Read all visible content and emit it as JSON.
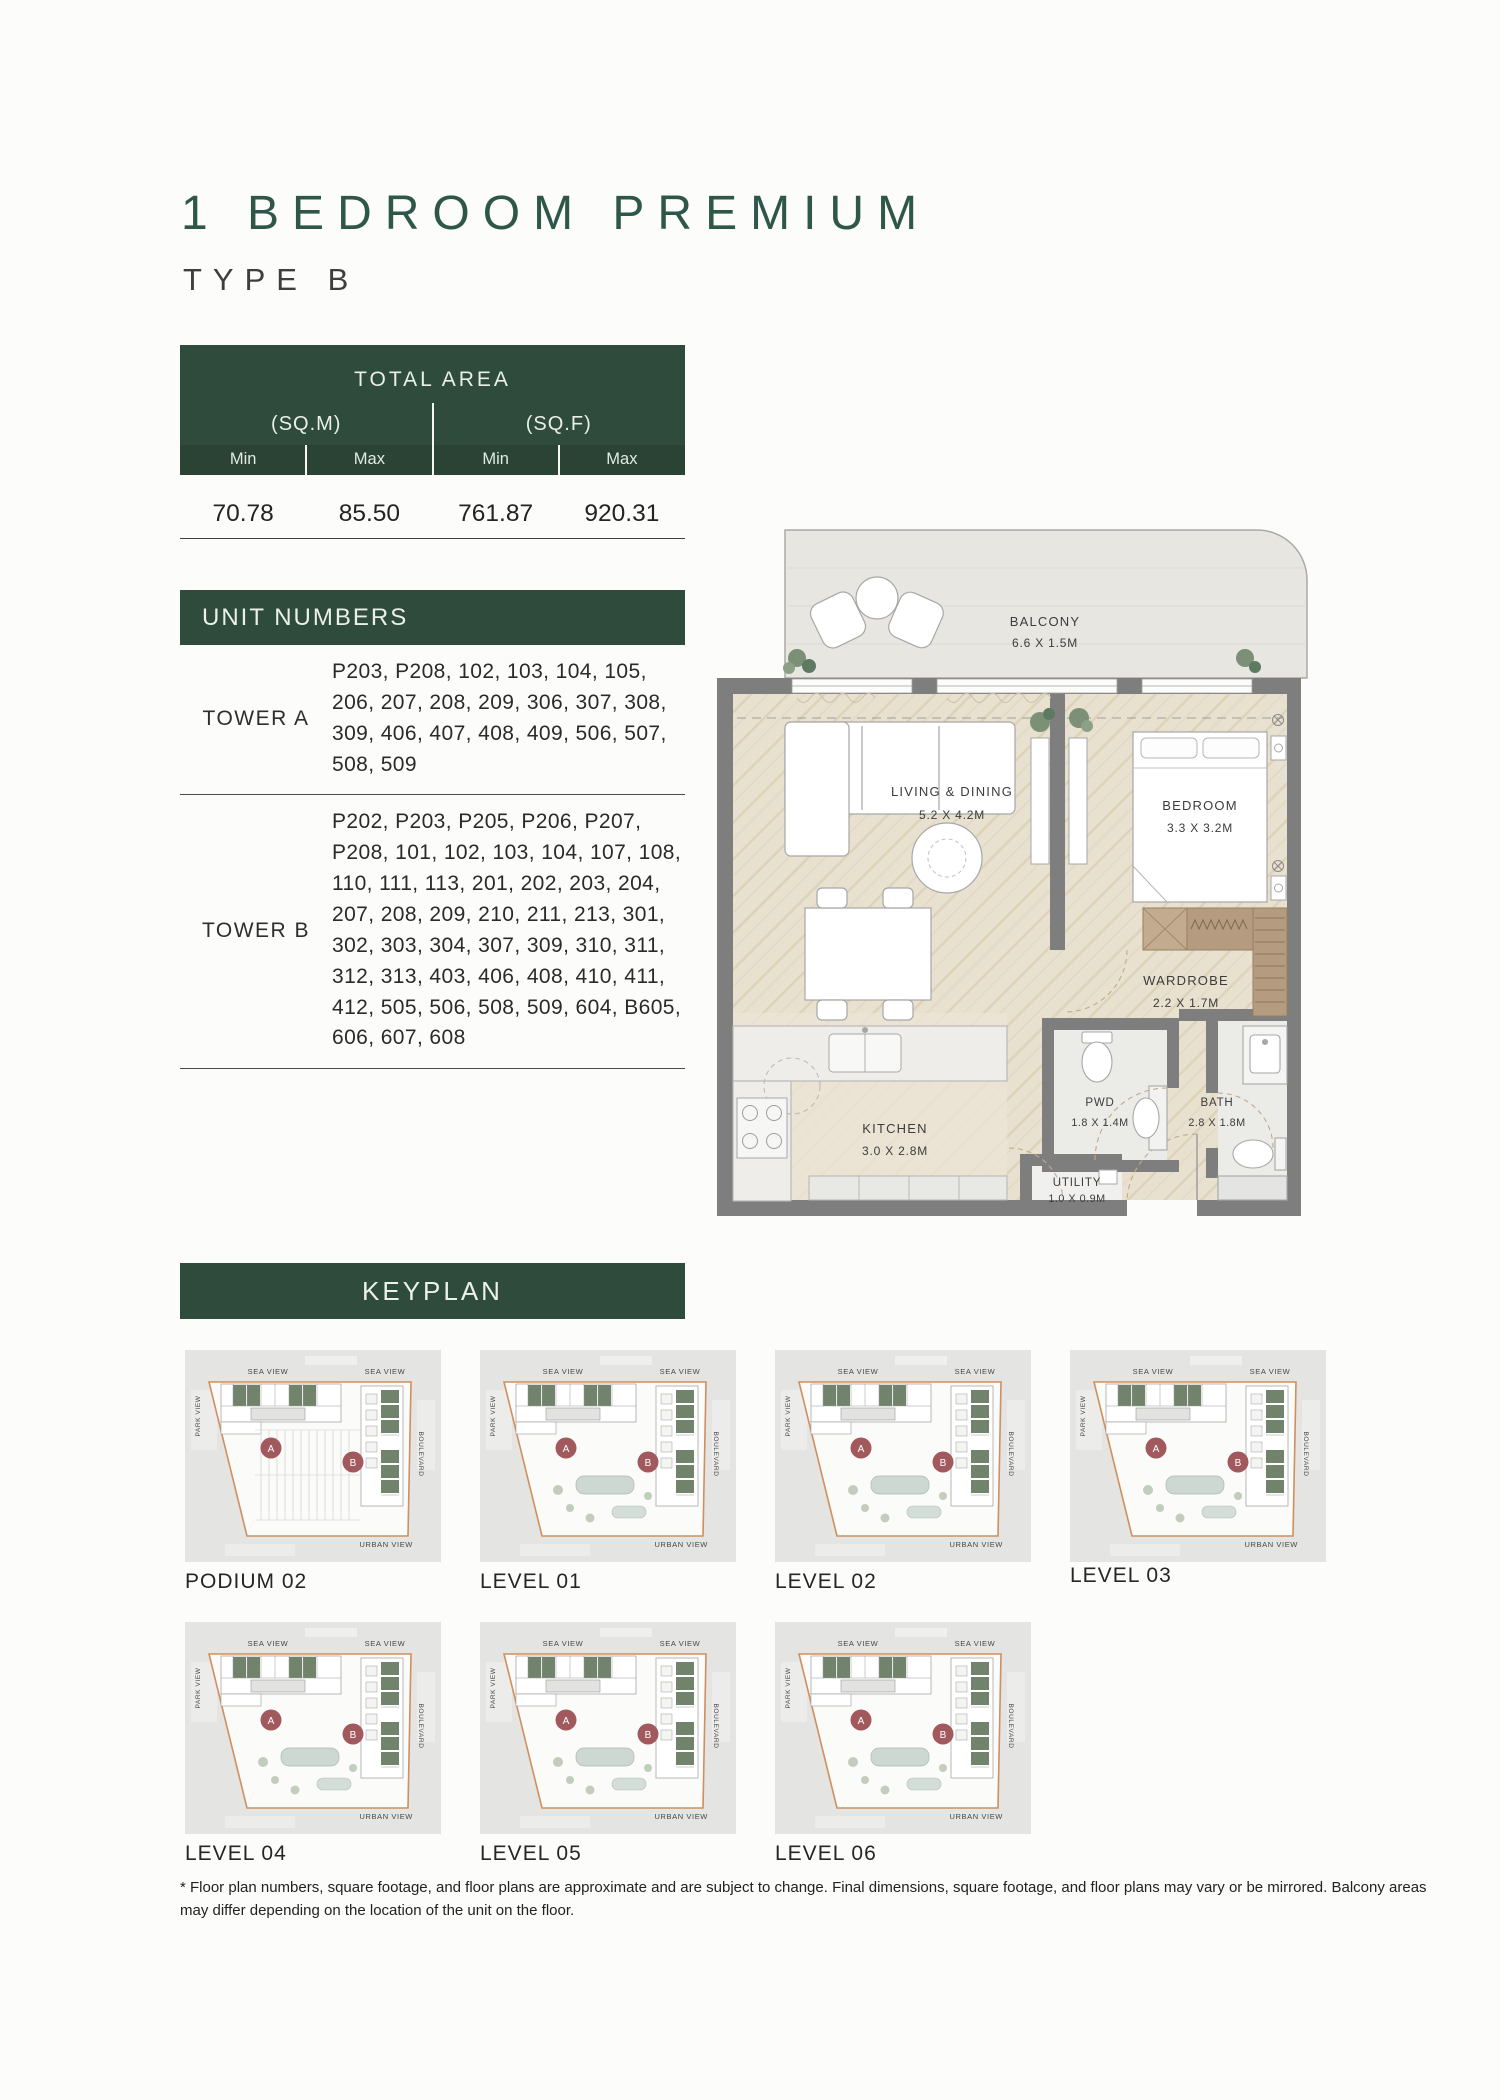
{
  "page": {
    "title": "1 BEDROOM PREMIUM",
    "subtitle": "TYPE B"
  },
  "area_table": {
    "title": "TOTAL AREA",
    "groups": [
      {
        "label": "(SQ.M)"
      },
      {
        "label": "(SQ.F)"
      }
    ],
    "col_labels": [
      "Min",
      "Max",
      "Min",
      "Max"
    ],
    "values": [
      "70.78",
      "85.50",
      "761.87",
      "920.31"
    ]
  },
  "unit_numbers": {
    "title": "UNIT NUMBERS",
    "rows": [
      {
        "tower": "TOWER A",
        "units": "P203, P208, 102, 103, 104, 105, 206, 207, 208, 209, 306, 307, 308, 309, 406, 407, 408, 409, 506, 507, 508, 509"
      },
      {
        "tower": "TOWER B",
        "units": "P202, P203, P205, P206, P207, P208, 101, 102, 103, 104, 107, 108, 110, 111, 113, 201, 202, 203, 204, 207, 208, 209, 210, 211, 213, 301, 302, 303, 304, 307, 309, 310, 311, 312, 313, 403, 406, 408, 410, 411, 412, 505, 506, 508, 509, 604, B605, 606, 607, 608"
      }
    ]
  },
  "floor_plan": {
    "rooms": [
      {
        "name": "BALCONY",
        "dims": "6.6 X 1.5M"
      },
      {
        "name": "LIVING & DINING",
        "dims": "5.2 X 4.2M"
      },
      {
        "name": "BEDROOM",
        "dims": "3.3 X 3.2M"
      },
      {
        "name": "WARDROBE",
        "dims": "2.2 X 1.7M"
      },
      {
        "name": "KITCHEN",
        "dims": "3.0 X 2.8M"
      },
      {
        "name": "PWD",
        "dims": "1.8 X 1.4M"
      },
      {
        "name": "BATH",
        "dims": "2.8 X 1.8M"
      },
      {
        "name": "UTILITY",
        "dims": "1.0 X 0.9M"
      }
    ]
  },
  "keyplan": {
    "title": "KEYPLAN",
    "compass": {
      "sea_view_left": "SEA VIEW",
      "sea_view_right": "SEA VIEW",
      "park_view": "PARK VIEW",
      "boulevard": "BOULEVARD",
      "urban_view": "URBAN VIEW"
    },
    "badges": {
      "tower_a": "A",
      "tower_b": "B"
    },
    "levels": [
      {
        "label": "PODIUM 02"
      },
      {
        "label": "LEVEL 01"
      },
      {
        "label": "LEVEL 02"
      },
      {
        "label": "LEVEL 03"
      },
      {
        "label": "LEVEL 04"
      },
      {
        "label": "LEVEL 05"
      },
      {
        "label": "LEVEL 06"
      }
    ]
  },
  "footer": {
    "disclaimer": "* Floor plan numbers, square footage, and floor plans are approximate and are subject to change. Final dimensions, square footage, and floor plans may vary or be mirrored. Balcony areas may differ depending on the location of the unit on the floor."
  },
  "colors": {
    "brand_green": "#2F4B3C",
    "title_green": "#2E574A",
    "badge_maroon": "#A2595D",
    "keyplan_boundary_orange": "#CF8F5E",
    "keyplan_unit_green": "#71836B"
  }
}
